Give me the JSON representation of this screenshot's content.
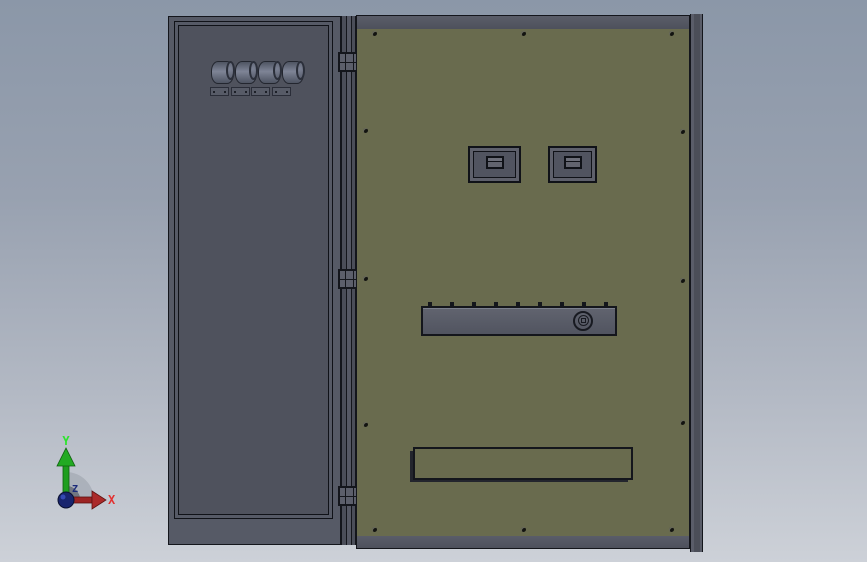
{
  "viewport": {
    "background_top": "#8b97a8",
    "background_bottom": "#cdd1d8",
    "content": "3D CAD model of an electrical cabinet enclosure, front view"
  },
  "triad": {
    "x_label": "X",
    "y_label": "Y",
    "z_label": "Z",
    "x_color": "#e23232",
    "y_color": "#2ce42c",
    "z_color": "#1b2a7a"
  },
  "model": {
    "name": "electrical-cabinet",
    "door_color": "#4f525d",
    "frame_color": "#565a66",
    "back_panel_color": "#696b4e",
    "band_color": "#535663",
    "hardware_color": "#5d606b",
    "counts": {
      "cylinders": 4,
      "mounting_plates": 4,
      "hinges": 3,
      "panel_screws": 12,
      "meter_windows": 2,
      "grille_columns": 20,
      "grille_rows": 3,
      "strip_clips": 9
    },
    "components": [
      "left-door",
      "hinge-rail",
      "terminal-cylinders",
      "mounting-plates",
      "back-panel",
      "meter-window-left",
      "meter-window-right",
      "breaker-strip",
      "lock-knob",
      "ventilation-grille",
      "orientation-triad"
    ]
  }
}
